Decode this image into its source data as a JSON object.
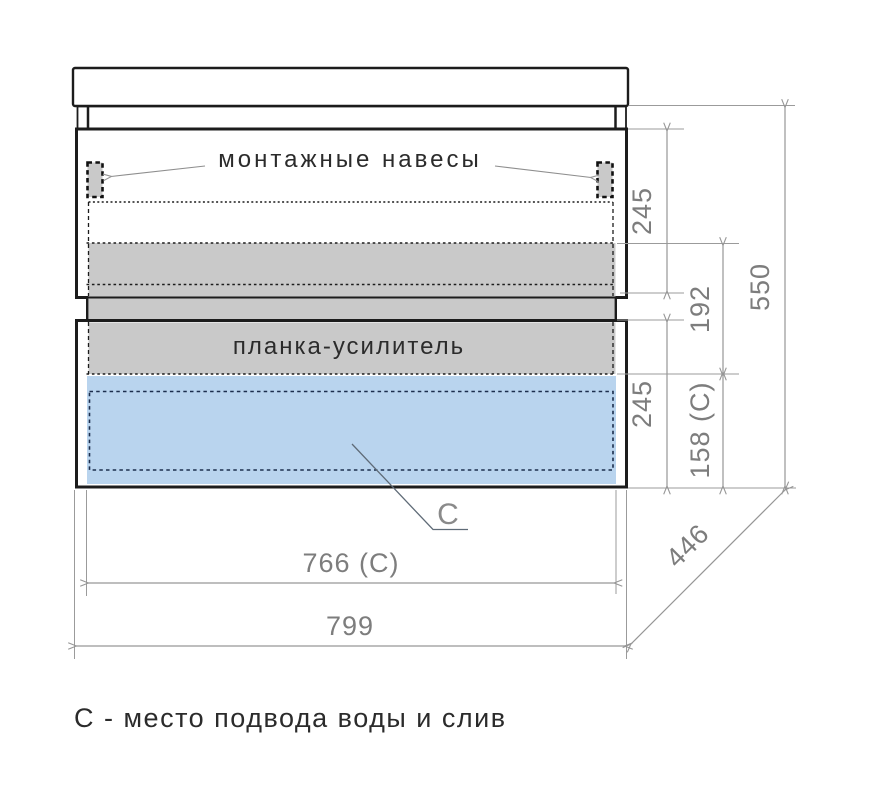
{
  "title": "vanity-cabinet-technical-drawing",
  "labels": {
    "mounting_hangers": "монтажные навесы",
    "reinforcement_bar": "планка-усилитель",
    "c_marker": "C",
    "caption": "С - место подвода воды и слив"
  },
  "dimensions": {
    "upper_drawer_height": "245",
    "hanger_to_bar": "192",
    "lower_drawer_height": "245",
    "c_zone_height": "158 (C)",
    "total_height": "550",
    "inner_width": "766 (C)",
    "total_width": "799",
    "depth": "446"
  },
  "colors": {
    "band_gray": "#c9c9c9",
    "c_zone_blue": "#b9d4ee",
    "outline_black": "#1c1c1c",
    "dashed_navy": "#1c2e4d",
    "dim_line_gray": "#969696",
    "dim_text_gray": "#7d7d7d",
    "label_dark": "#2b2b2b",
    "background": "#ffffff"
  }
}
